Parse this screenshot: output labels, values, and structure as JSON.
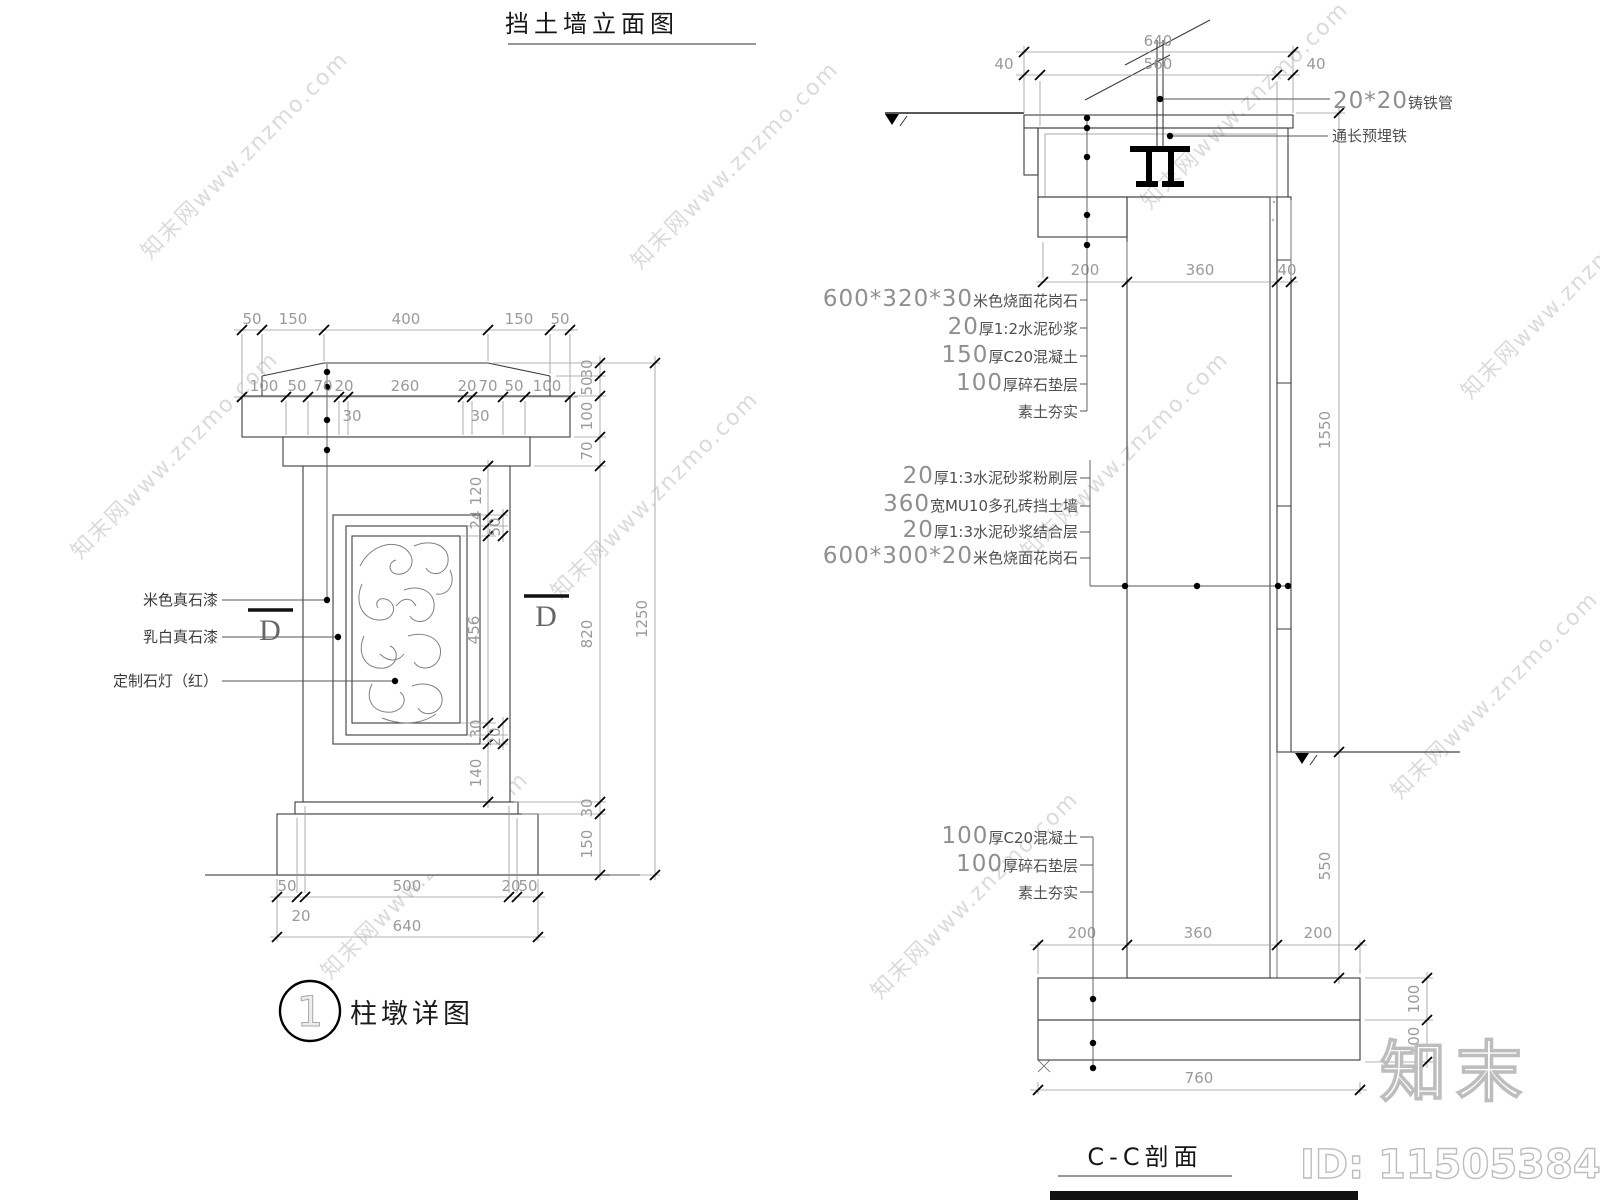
{
  "titles": {
    "left": "挡土墙立面图",
    "right": "C-C剖面",
    "detail": "柱墩详图",
    "detail_num": "1"
  },
  "watermark": {
    "text": "知末网www.znzmo.com",
    "logo": "知末",
    "id": "ID: 1150538465"
  },
  "left": {
    "labels": {
      "paint1": "米色真石漆",
      "paint2": "乳白真石漆",
      "lamp": "定制石灯（红）",
      "d": "D"
    },
    "dims": {
      "top1": [
        "50",
        "150",
        "400",
        "150",
        "50"
      ],
      "top2": [
        "100",
        "50",
        "70",
        "20",
        "260",
        "20",
        "70",
        "50",
        "100"
      ],
      "top2_sub": [
        "30",
        "30"
      ],
      "right": [
        "30",
        "50",
        "100",
        "70",
        "820",
        "30",
        "150"
      ],
      "right_total": "1250",
      "panel": [
        "120",
        "24",
        "50",
        "456",
        "30",
        "20",
        "140"
      ],
      "bottom": [
        "50",
        "20",
        "500",
        "20",
        "50"
      ],
      "bottom_total": "640"
    }
  },
  "right": {
    "dims": {
      "top_total": "640",
      "top": [
        "40",
        "560",
        "40"
      ],
      "upper": [
        "200",
        "360",
        "40"
      ],
      "h1": "1550",
      "h2": "550",
      "bottom": [
        "200",
        "360",
        "200"
      ],
      "bottom_total": "760",
      "foot": [
        "100",
        "100"
      ]
    },
    "ann": {
      "pipe_num": "20*20",
      "pipe_cn": "铸铁管",
      "embed": "通长预埋铁",
      "s1": [
        {
          "n": "600*320*30",
          "c": "米色烧面花岗石"
        },
        {
          "n": "20",
          "c": "厚1:2水泥砂浆"
        },
        {
          "n": "150",
          "c": "厚C20混凝土"
        },
        {
          "n": "100",
          "c": "厚碎石垫层"
        },
        {
          "n": "",
          "c": "素土夯实"
        }
      ],
      "s2": [
        {
          "n": "20",
          "c": "厚1:3水泥砂浆粉刷层"
        },
        {
          "n": "360",
          "c": "宽MU10多孔砖挡土墙"
        },
        {
          "n": "20",
          "c": "厚1:3水泥砂浆结合层"
        },
        {
          "n": "600*300*20",
          "c": "米色烧面花岗石"
        }
      ],
      "s3": [
        {
          "n": "100",
          "c": "厚C20混凝土"
        },
        {
          "n": "100",
          "c": "厚碎石垫层"
        },
        {
          "n": "",
          "c": "素土夯实"
        }
      ]
    }
  }
}
